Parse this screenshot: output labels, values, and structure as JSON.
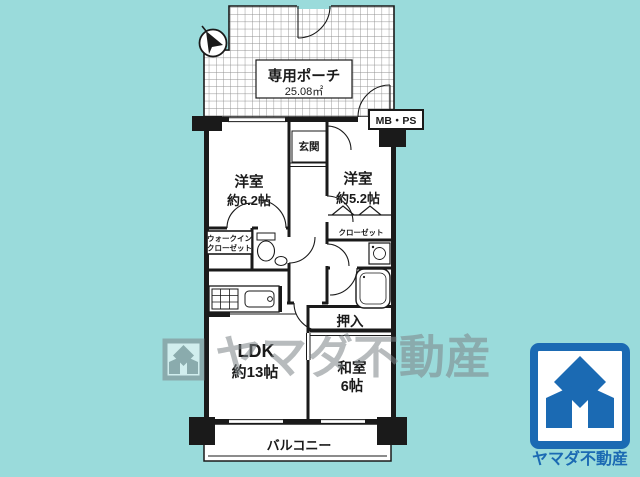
{
  "colors": {
    "background": "#9adbdb",
    "line": "#1a1a1a",
    "logo_blue": "#1b6ab3",
    "watermark_gray": "#7d8588"
  },
  "floorplan": {
    "porch": {
      "label": "専用ポーチ",
      "area": "25.08㎡"
    },
    "shaft_label": "MB・PS",
    "entrance_label": "玄関",
    "western_room_1": {
      "name": "洋室",
      "size": "約6.2帖"
    },
    "western_room_2": {
      "name": "洋室",
      "size": "約5.2帖"
    },
    "walk_in_closet": {
      "line1": "ウォークイン",
      "line2": "クローゼット"
    },
    "closet_label": "クローゼット",
    "oshiire_label": "押入",
    "ldk": {
      "name": "LDK",
      "size": "約13帖"
    },
    "japanese_room": {
      "name": "和室",
      "size": "6帖"
    },
    "balcony_label": "バルコニー"
  },
  "watermark": {
    "text": "ヤマダ不動産"
  },
  "footer_logo": {
    "company": "ヤマダ不動産"
  }
}
